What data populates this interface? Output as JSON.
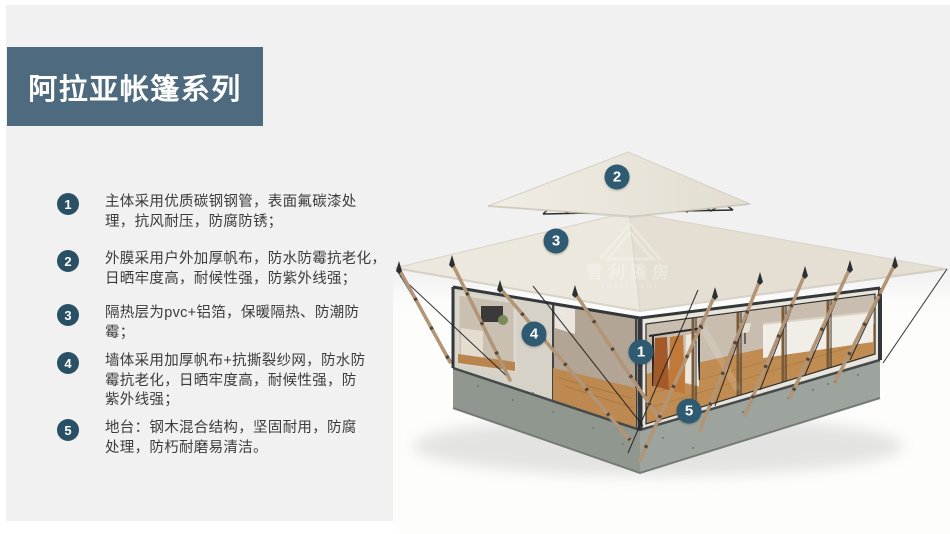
{
  "slide": {
    "title": "阿拉亚帐篷系列"
  },
  "features": [
    {
      "num": "1",
      "lines": [
        "主体采用优质碳钢钢管，表面氟碳漆处",
        "理，抗风耐压，防腐防锈；"
      ]
    },
    {
      "num": "2",
      "lines": [
        "外膜采用户外加厚帆布，防水防霉抗老化，",
        "日晒牢度高，耐候性强，防紫外线强；"
      ]
    },
    {
      "num": "3",
      "lines": [
        "隔热层为pvc+铝箔，保暖隔热、防潮防",
        "霉；"
      ]
    },
    {
      "num": "4",
      "lines": [
        "墙体采用加厚帆布+抗撕裂纱网，防水防",
        "霉抗老化，日晒牢度高，耐候性强，防",
        "紫外线强；"
      ]
    },
    {
      "num": "5",
      "lines": [
        "地台：钢木混合结构，坚固耐用，防腐",
        "处理，防朽耐磨易清洁。"
      ]
    }
  ],
  "image_markers": [
    {
      "label": "1",
      "x": 641,
      "y": 352
    },
    {
      "label": "2",
      "x": 617,
      "y": 177
    },
    {
      "label": "3",
      "x": 556,
      "y": 241
    },
    {
      "label": "4",
      "x": 534,
      "y": 334
    },
    {
      "label": "5",
      "x": 689,
      "y": 411
    }
  ],
  "watermark": {
    "text": "雪利篷房",
    "subtext": "XUELI TENT"
  },
  "colors": {
    "background": "#f1f1f2",
    "banner": "#4d6a7e",
    "list_badge": "#2a5066",
    "image_marker": "#2e5a72",
    "body_text": "#3b3b3b",
    "canvas_cream": "#e9e4d8",
    "base_gray": "#99a099",
    "wood_pole": "#b29476"
  }
}
